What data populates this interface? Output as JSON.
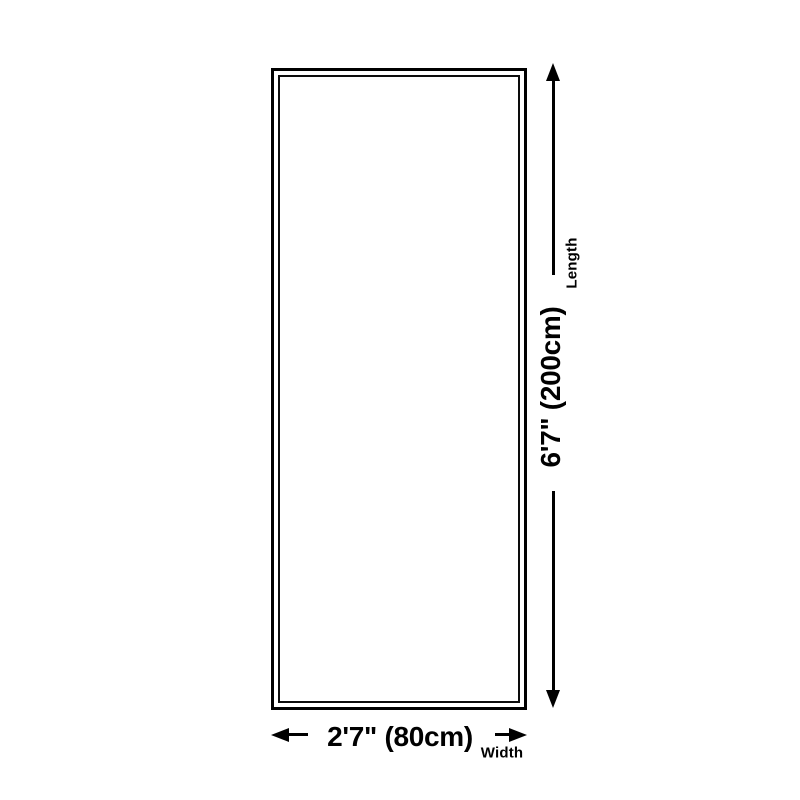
{
  "colors": {
    "background": "#ffffff",
    "line": "#000000",
    "text": "#000000"
  },
  "rectangle": {
    "shape": "rectangle",
    "fill": "#ffffff",
    "border_color": "#000000",
    "border_style": "double"
  },
  "length_dimension": {
    "label": "Length",
    "value": "6'7\" (200cm)"
  },
  "width_dimension": {
    "label": "Width",
    "value": "2'7\" (80cm)"
  }
}
